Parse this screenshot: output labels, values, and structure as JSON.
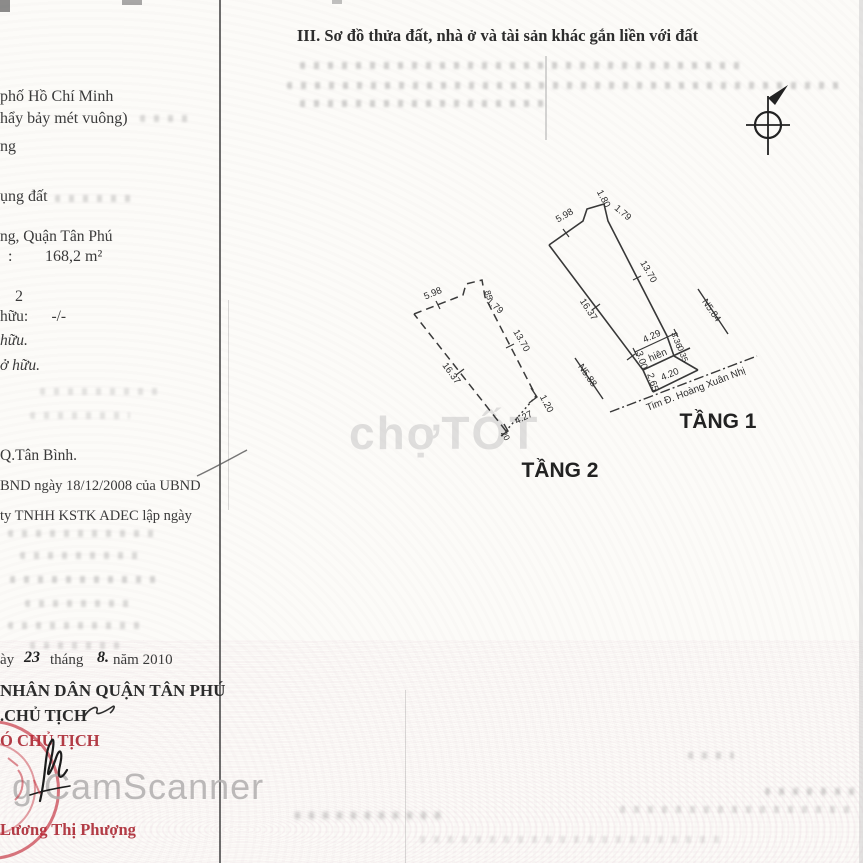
{
  "title": "III. Sơ đồ thửa đất, nhà ở và tài sản khác gắn liền với đất",
  "left_column": {
    "city": "phố Hồ Chí Minh",
    "area_words": "hẩy bảy mét vuông)",
    "ng": "ng",
    "land_use": "ụng đất",
    "district": "ng, Quận Tân Phú",
    "colon": ":",
    "area_value": "168,2 m²",
    "floors": "2",
    "own1": "hữu:      -/-",
    "own2": "hữu.",
    "own3": "ở hữu.",
    "tan_binh": "Q.Tân Bình.",
    "ubnd": "BND ngày 18/12/2008 của UBND",
    "adec": "ty TNHH KSTK ADEC lập ngày",
    "date_prefix": "ày",
    "date_day": "23",
    "date_thang": "tháng",
    "date_month": "8.",
    "date_suffix": "năm 2010",
    "committee": "NHÂN DÂN QUẬN TÂN PHÚ",
    "kt_chairman": ".CHỦ TỊCH",
    "vice_chairman": "Ó CHỦ TỊCH",
    "signer": "Lương Thị Phượng"
  },
  "diagram": {
    "floor1": {
      "label": "TẦNG 1",
      "dim_top": "5.98",
      "dim_notch_top": "1.80",
      "dim_notch_side": "1.79",
      "dim_right": "13.70",
      "dim_left": "16.37",
      "dim_porch_width": "4.29",
      "porch_label": "hiên",
      "dim_left_low": "3.00",
      "dim_left_low2": "2.65",
      "dim_bottom": "4.20",
      "dim_right_low": "3.36",
      "dim_right_low2": "0.35",
      "neighbor_left": "N5.88",
      "neighbor_right": "N5.84",
      "street": "Tim Đ. Hoàng Xuân Nhị"
    },
    "floor2": {
      "label": "TẦNG 2",
      "dim_top": "5.98",
      "dim_notch_top": "85",
      "dim_notch_side": "1.79",
      "dim_right": "13.70",
      "dim_left": "16.37",
      "dim_corner_right": "1.20",
      "dim_bottom": "4.27",
      "dim_corner_left": "20"
    }
  },
  "watermarks": {
    "chotot": "chợTỐT",
    "camscanner": "g CamScanner"
  },
  "colors": {
    "stamp_red": "#c32d3a",
    "ink": "#3a3a3a"
  }
}
